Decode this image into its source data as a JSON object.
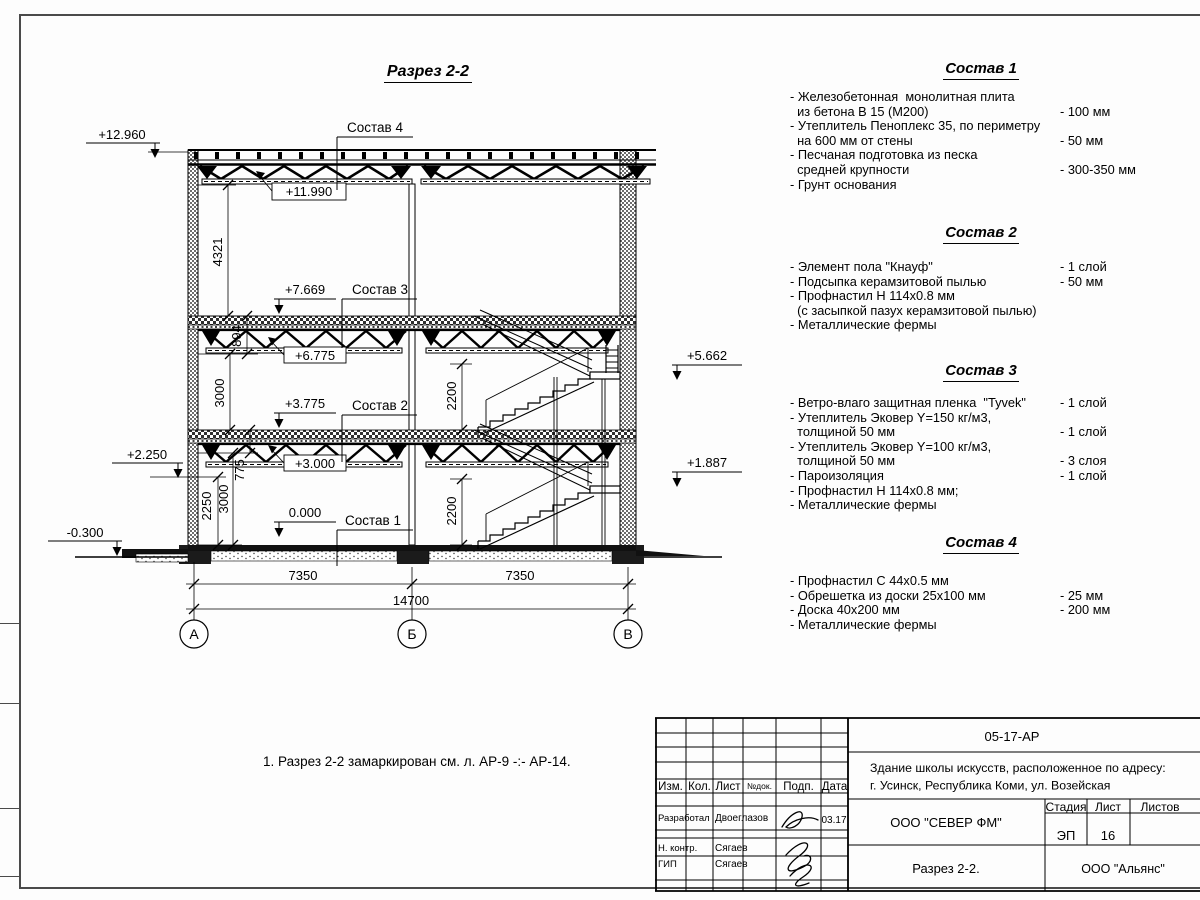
{
  "section": {
    "title": "Разрез 2-2",
    "callout4": "Состав 4",
    "callout3": "Состав 3",
    "callout2": "Состав 2",
    "callout1": "Состав 1",
    "elev_12960": "+12.960",
    "elev_11990": "+11.990",
    "elev_7669": "+7.669",
    "elev_6775": "+6.775",
    "elev_3775": "+3.775",
    "elev_3000": "+3.000",
    "elev_0000": "0.000",
    "elev_2250": "+2.250",
    "elev_m0300": "-0.300",
    "elev_5662": "+5.662",
    "elev_1887": "+1.887",
    "dim_4321": "4321",
    "dim_894": "894",
    "dim_3000_upper": "3000",
    "dim_775": "775",
    "dim_2250": "2250",
    "dim_3000_lower": "3000",
    "dim_2200_upper": "2200",
    "dim_2200_lower": "2200",
    "dim_7350_left": "7350",
    "dim_7350_right": "7350",
    "dim_14700": "14700",
    "axis_a": "А",
    "axis_b": "Б",
    "axis_v": "В"
  },
  "note": "1. Разрез 2-2 замаркирован см. л. АР-9 -:- АР-14.",
  "compositions": [
    {
      "heading": "Состав 1",
      "items": [
        {
          "text": "- Железобетонная  монолитная плита",
          "value": ""
        },
        {
          "text": "  из бетона В 15 (М200)",
          "value": "- 100 мм"
        },
        {
          "text": "- Утеплитель Пеноплекс 35, по периметру",
          "value": ""
        },
        {
          "text": "  на 600 мм от стены",
          "value": "- 50 мм"
        },
        {
          "text": "- Песчаная подготовка из песка",
          "value": ""
        },
        {
          "text": "  средней крупности",
          "value": "- 300-350 мм"
        },
        {
          "text": "- Грунт основания",
          "value": ""
        }
      ]
    },
    {
      "heading": "Состав 2",
      "items": [
        {
          "text": "- Элемент пола \"Кнауф\"",
          "value": "- 1 слой"
        },
        {
          "text": "- Подсыпка керамзитовой пылью",
          "value": "- 50 мм"
        },
        {
          "text": "- Профнастил Н 114х0.8 мм",
          "value": ""
        },
        {
          "text": "  (с засыпкой пазух керамзитовой пылью)",
          "value": ""
        },
        {
          "text": "- Металлические фермы",
          "value": ""
        }
      ]
    },
    {
      "heading": "Состав 3",
      "items": [
        {
          "text": "- Ветро-влаго защитная пленка  \"Tyvek\"",
          "value": "- 1 слой"
        },
        {
          "text": "- Утеплитель Эковер Y=150 кг/м3,",
          "value": ""
        },
        {
          "text": "  толщиной 50 мм",
          "value": "- 1 слой"
        },
        {
          "text": "- Утеплитель Эковер Y=100 кг/м3,",
          "value": ""
        },
        {
          "text": "  толщиной 50 мм",
          "value": "- 3 слоя"
        },
        {
          "text": "- Пароизоляция",
          "value": "- 1 слой"
        },
        {
          "text": "- Профнастил Н 114х0.8 мм;",
          "value": ""
        },
        {
          "text": "- Металлические фермы",
          "value": ""
        }
      ]
    },
    {
      "heading": "Состав 4",
      "items": [
        {
          "text": "- Профнастил С 44х0.5 мм",
          "value": ""
        },
        {
          "text": "- Обрешетка из доски 25х100 мм",
          "value": "- 25 мм"
        },
        {
          "text": "- Доска 40х200 мм",
          "value": "- 200 мм"
        },
        {
          "text": "- Металлические фермы",
          "value": ""
        }
      ]
    }
  ],
  "stamp": {
    "doc_code": "05-17-АР",
    "project_line1": "Здание школы искусств, расположенное по адресу:",
    "project_line2": "г. Усинск, Республика Коми, ул. Возейская",
    "org": "ООО \"СЕВЕР ФМ\"",
    "sheet_title": "Разрез 2-2.",
    "contractor": "ООО \"Альянс\"",
    "col_izm": "Изм.",
    "col_kol": "Кол.",
    "col_list": "Лист",
    "col_ndok": "№док.",
    "col_podp": "Подп.",
    "col_data": "Дата",
    "row1_role": "Разработал",
    "row1_name": "Двоеглазов",
    "row1_date": "03.17",
    "row2_role": "Н. контр.",
    "row2_name": "Сягаев",
    "row3_role": "ГИП",
    "row3_name": "Сягаев",
    "stage_label": "Стадия",
    "sheet_label": "Лист",
    "sheets_label": "Листов",
    "stage": "ЭП",
    "sheet_no": "16"
  }
}
